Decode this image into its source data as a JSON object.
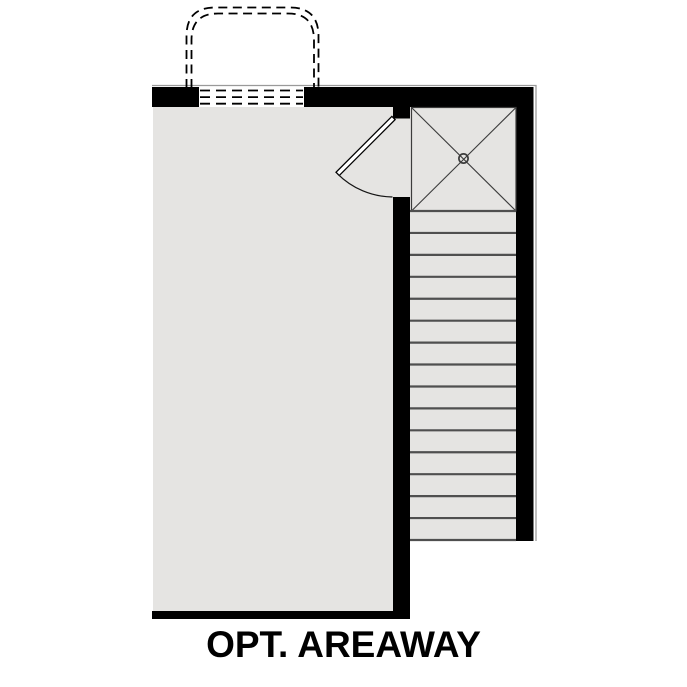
{
  "plan": {
    "label": "OPT. AREAWAY",
    "colors": {
      "background": "#ffffff",
      "wall": "#000000",
      "floor": "#e5e4e2",
      "tread_line": "#4f4f4f",
      "detail_line": "#3c3c3c",
      "door_leaf": "#ffffff",
      "hairline": "#9a9a9a",
      "label_color": "#000000"
    },
    "stairs": {
      "tread_count": 15,
      "x_left": 410,
      "x_right": 516,
      "y_top": 211,
      "y_bottom": 540
    },
    "basement_window": {
      "dash_rows": 3,
      "x_left": 200,
      "x_right": 303,
      "y_first": 90.5,
      "row_gap": 6.6
    },
    "landing": {
      "symbol": "cross-with-center-circle"
    },
    "areaway_outline": {
      "style": "double-dashed-rounded-rectangle"
    },
    "door": {
      "type": "swing",
      "open_angle_deg": 45
    }
  }
}
